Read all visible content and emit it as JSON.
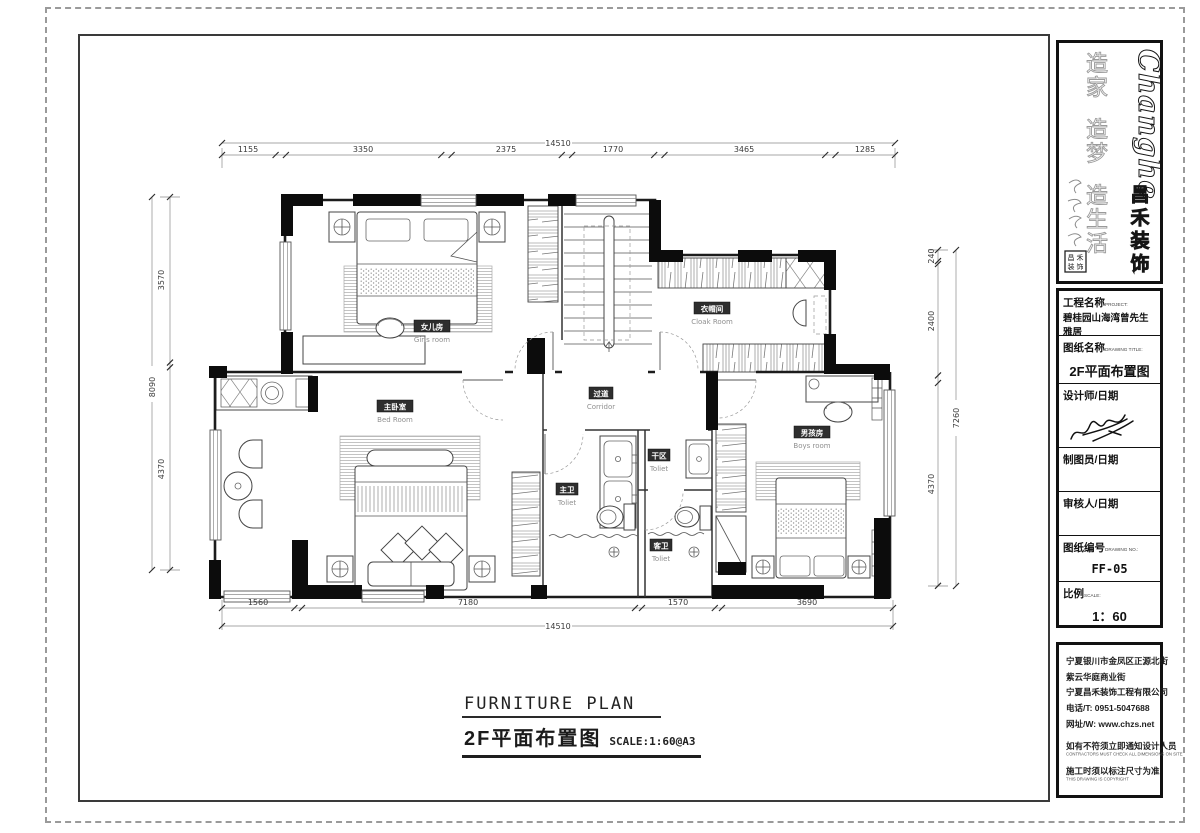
{
  "drawing": {
    "title_en": "FURNITURE PLAN",
    "title_cn": "2F平面布置图",
    "scale_note": "SCALE:1:60@A3"
  },
  "rooms": {
    "girls": {
      "cn": "女儿房",
      "en": "Girls room"
    },
    "cloak": {
      "cn": "衣帽间",
      "en": "Cloak Room"
    },
    "corridor": {
      "cn": "过道",
      "en": "Corridor"
    },
    "master": {
      "cn": "主卧室",
      "en": "Bed Room"
    },
    "boys": {
      "cn": "男孩房",
      "en": "Boys room"
    },
    "master_bath": {
      "cn": "主卫",
      "en": "Toliet"
    },
    "dry_area": {
      "cn": "干区",
      "en": "Toliet"
    },
    "guest_bath": {
      "cn": "客卫",
      "en": "Toliet"
    }
  },
  "dims": {
    "top": {
      "total": "14510",
      "segments": [
        "1155",
        "3350",
        "2375",
        "1770",
        "3465",
        "1285"
      ]
    },
    "bottom": {
      "total": "14510",
      "segments": [
        "1560",
        "7180",
        "1570",
        "3690"
      ]
    },
    "left": {
      "total": "8090",
      "segments": [
        "3570",
        "4370"
      ]
    },
    "right": {
      "total": "7260",
      "segments": [
        "240",
        "2400",
        "4370"
      ]
    }
  },
  "brand": {
    "logo_en": "Changhe",
    "logo_cn": [
      "昌",
      "禾",
      "装",
      "饰"
    ],
    "slogan": [
      "造",
      "家",
      "造",
      "梦",
      "造",
      "生",
      "活"
    ],
    "seal": [
      "昌",
      "禾",
      "装",
      "饰"
    ]
  },
  "title_block": {
    "project_label": "工程名称",
    "project_sub": "PROJECT:",
    "project_value": "碧桂园山海湾曾先生雅居",
    "drawing_label": "图纸名称",
    "drawing_sub": "DRAWING TITLE:",
    "drawing_value": "2F平面布置图",
    "designer_label": "设计师/日期",
    "designer_sub": "DESIGN/DATE:",
    "drafter_label": "制图员/日期",
    "drafter_sub": "DRAWN/DATE:",
    "approver_label": "审核人/日期",
    "approver_sub": "APPROVED/DATE:",
    "no_label": "图纸编号",
    "no_sub": "DRAWING NO.:",
    "no_value": "FF-05",
    "scale_label": "比例",
    "scale_sub": "SCALE:",
    "scale_value": "1：60"
  },
  "company": {
    "address_lines": [
      "宁夏银川市金凤区正源北街",
      "紫云华庭商业街",
      "宁夏昌禾装饰工程有限公司",
      "电话/T: 0951-5047688",
      "网址/W: www.chzs.net"
    ],
    "note1_cn": "如有不符须立即通知设计人员",
    "note1_en": "CONTRACTORS MUST CHECK ALL DIMENSIONS ON SITE",
    "note2_cn": "施工时须以标注尺寸为准",
    "note2_en": "THIS DRAWING IS COPYRIGHT"
  }
}
